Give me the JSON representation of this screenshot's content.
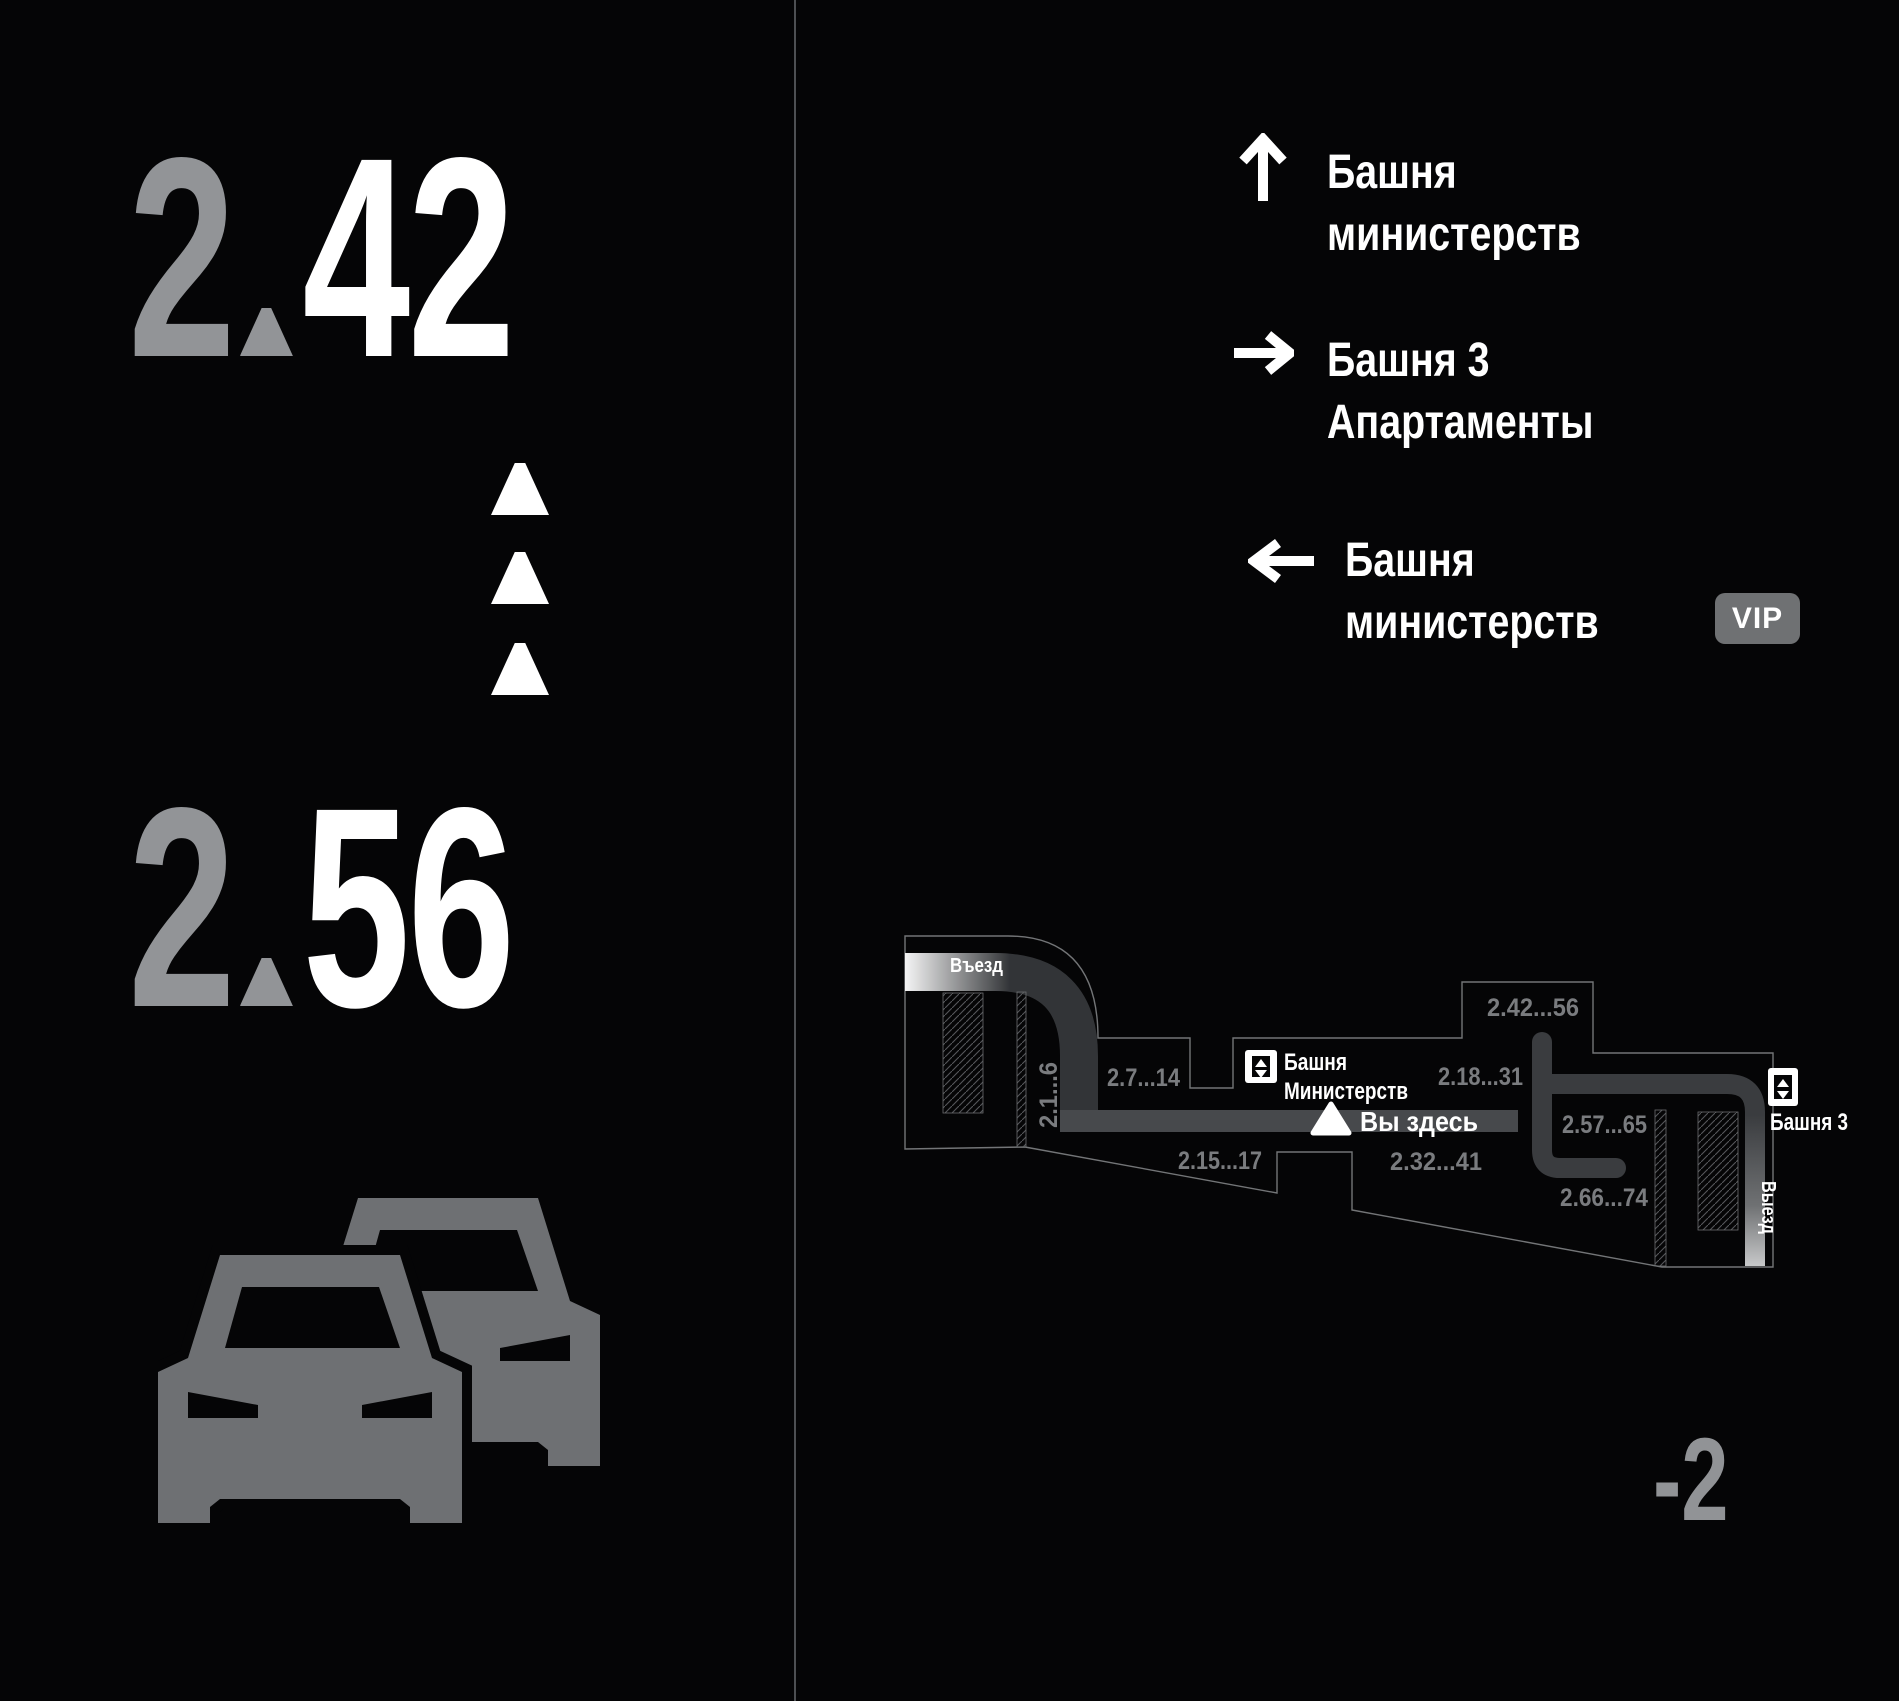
{
  "left_panel": {
    "top_number": {
      "whole": "2",
      "fraction": "42"
    },
    "bottom_number": {
      "whole": "2",
      "fraction": "56"
    },
    "floor": "-2"
  },
  "directions": [
    {
      "icon": "arrow-up",
      "line1": "Башня",
      "line2": "министерств",
      "vip": ""
    },
    {
      "icon": "arrow-right",
      "line1": "Башня 3",
      "line2": "Апартаменты",
      "vip": ""
    },
    {
      "icon": "arrow-left",
      "line1": "Башня",
      "line2": "министерств",
      "vip": "VIP"
    }
  ],
  "map": {
    "entrance_label": "Въезд",
    "exit_label": "Выезд",
    "you_are_here": "Вы здесь",
    "elevator_ministries": {
      "line1": "Башня",
      "line2": "Министерств"
    },
    "elevator_tower3": "Башня 3",
    "zones": {
      "z1": "2.1...6",
      "z2": "2.7...14",
      "z3": "2.18...31",
      "z4": "2.42...56",
      "z5": "2.15...17",
      "z6": "2.32...41",
      "z7": "2.57...65",
      "z8": "2.66...74"
    }
  },
  "colors": {
    "background": "#050506",
    "number_gray": "#929497",
    "number_white": "#ffffff",
    "zone_label_gray": "#7a7c7f",
    "road_dark": "#323437",
    "road_main": "#47494c",
    "vip_badge": "#6f7173",
    "car_gray": "#6e7073",
    "floor_gray": "#919396"
  }
}
